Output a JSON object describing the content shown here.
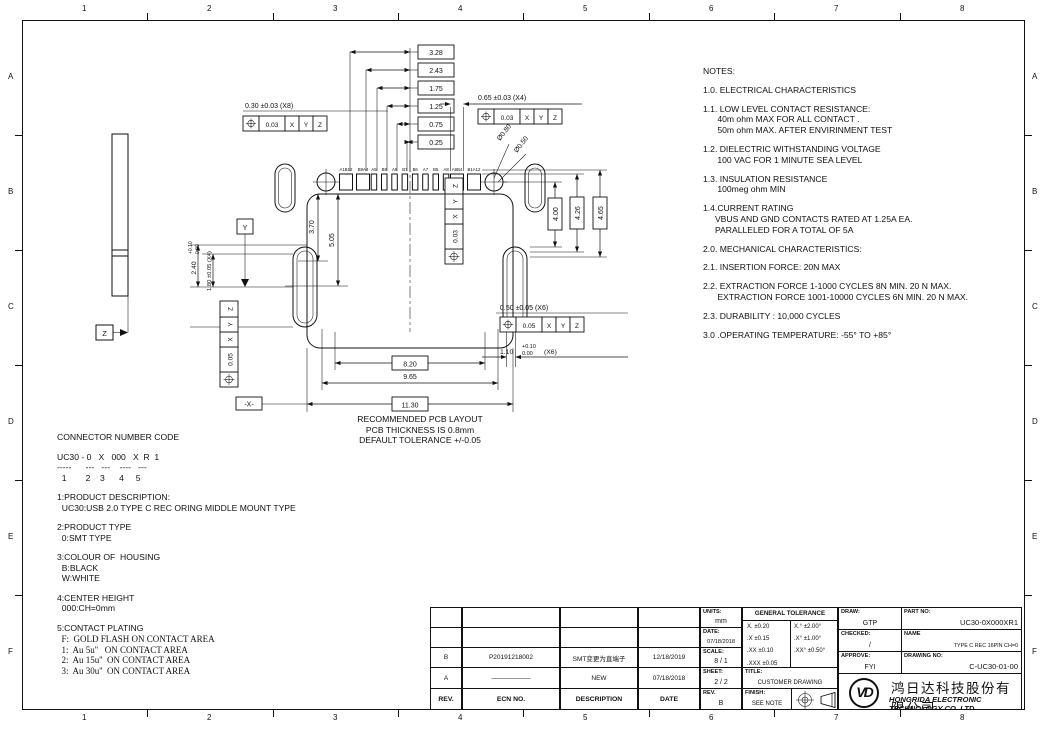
{
  "zones": {
    "cols": [
      "1",
      "2",
      "3",
      "4",
      "5",
      "6",
      "7",
      "8"
    ],
    "rows": [
      "A",
      "B",
      "C",
      "D",
      "E",
      "F"
    ]
  },
  "notes": {
    "heading": "NOTES:",
    "items": [
      "1.0. ELECTRICAL CHARACTERISTICS",
      "1.1. LOW LEVEL CONTACT RESISTANCE:\n      40m ohm MAX FOR ALL CONTACT .\n      50m ohm MAX. AFTER ENVIRINMENT TEST",
      "1.2. DIELECTRIC WITHSTANDING VOLTAGE\n      100 VAC FOR 1 MINUTE SEA LEVEL",
      "1.3. INSULATION RESISTANCE\n      100meg ohm MIN",
      "1.4.CURRENT RATING\n     VBUS AND GND CONTACTS RATED AT 1.25A EA.\n     PARALLELED FOR A TOTAL OF 5A",
      "2.0. MECHANICAL CHARACTERISTICS:",
      "2.1. INSERTION FORCE: 20N MAX",
      "2.2. EXTRACTION FORCE 1-1000 CYCLES 8N MIN. 20 N MAX.\n      EXTRACTION FORCE 1001-10000 CYCLES 6N MIN. 20 N MAX.",
      "2.3. DURABILITY : 10,000 CYCLES",
      "3.0 .OPERATING TEMPERATURE: -55° TO +85°"
    ]
  },
  "connector_code": {
    "heading": "CONNECTOR NUMBER CODE",
    "code_line": "UC30 - 0   X   000   X  R  1",
    "dash_line": "-----      ---   ---    ----   ---",
    "num_line": "  1        2    3      4     5",
    "sections": [
      "1:PRODUCT DESCRIPTION:\n  UC30:USB 2.0 TYPE C REC ORING MIDDLE MOUNT TYPE",
      "2:PRODUCT TYPE\n  0:SMT TYPE",
      "3:COLOUR OF  HOUSING\n  B:BLACK\n  W:WHITE",
      "4:CENTER HEIGHT\n  000:CH=0mm"
    ],
    "plating_heading": "5:CONTACT PLATING",
    "plating_lines": "  F:  GOLD FLASH ON CONTACT AREA\n  1:  Au 5u''   ON CONTACT AREA\n  2:  Au 15u''  ON CONTACT AREA\n  3:  Au 30u''  ON CONTACT AREA"
  },
  "pcb_note": "RECOMMENDED PCB LAYOUT\nPCB THICKNESS IS 0.8mm\nDEFAULT TOLERANCE +/-0.05",
  "drawing": {
    "stack_dims": [
      "3.28",
      "2.43",
      "1.75",
      "1.25",
      "0.75",
      "0.25"
    ],
    "pad_width_note": "0.30 ±0.03 (X8)",
    "wide_pad_note": "0.65 ±0.03 (X4)",
    "hole_dia_outer": "Ø0.80",
    "hole_dia_inner": "Ø0.50",
    "pin_labels": [
      "A1B12",
      "B9A4",
      "A5",
      "B8",
      "A6",
      "B7",
      "B6",
      "A7",
      "B5",
      "A8",
      "A9B4",
      "B1A12"
    ],
    "dim_3_70": "3.70",
    "dim_5_05": "5.05",
    "dim_4_00": "4.00",
    "dim_4_26": "4.26",
    "dim_4_65": "4.65",
    "dim_8_20": "8.20",
    "dim_9_65": "9.65",
    "dim_11_30": "11.30",
    "datum_x_label": "-X-",
    "datum_y_label": "Y",
    "datum_z_label": "Z",
    "slot_note": "0.50 ±0.05 (X6)",
    "slot_dim_main": "1.10",
    "slot_dim_plus": "+0.10",
    "slot_dim_minus": "0.00",
    "slot_dim_qty": "(X6)",
    "left_dim_main": "2.40",
    "left_dim_plus": "+0.10",
    "left_dim_minus": "0.00",
    "left_dim2": "1.80 ±0.05 (X4)",
    "fcf": {
      "symbol_name": "position-tolerance",
      "tol_003": "0.03",
      "tol_005": "0.05"
    },
    "datums": {
      "x": "X",
      "y": "Y",
      "z": "Z"
    }
  },
  "title_block": {
    "rev_table": {
      "headers": [
        "REV.",
        "ECN NO.",
        "DESCRIPTION",
        "DATE"
      ],
      "rows": [
        {
          "rev": "B",
          "ecn": "P20191218002",
          "desc": "SMT变更为直端子",
          "date": "12/18/2019"
        },
        {
          "rev": "A",
          "ecn": "——————",
          "desc": "NEW",
          "date": "07/18/2018"
        }
      ]
    },
    "units_label": "UNITS:",
    "units_value": "mm",
    "date_label": "DATE:",
    "date_value": "07/18/2018",
    "scale_label": "SCALE:",
    "scale_value": "8 / 1",
    "sheet_label": "SHEET:",
    "sheet_value": "2 / 2",
    "rev_label": "REV.",
    "rev_value": "B",
    "tolerance": {
      "heading": "GENERAL TOLERANCE",
      "rows": [
        [
          "X.   ±0.20",
          "X.°   ±2.00°"
        ],
        [
          ".X   ±0.15",
          ".X°   ±1.00°"
        ],
        [
          ".XX  ±0.10",
          ".XX°  ±0.50°"
        ],
        [
          ".XXX ±0.05",
          ""
        ]
      ]
    },
    "title_label": "TITLE:",
    "title_value": "CUSTOMER DRAWING",
    "finish_label": "FINISH:",
    "finish_value": "SEE NOTE",
    "draw_label": "DRAW:",
    "draw_value": "GTP",
    "checked_label": "CHECKED:",
    "checked_value": "/",
    "approve_label": "APPROVE:",
    "approve_value": "FYI",
    "part_label": "PART NO:",
    "part_value": "UC30-0X000XR1",
    "name_label": "NAME",
    "name_value": "TYPE C REC 16PIN CH=0",
    "drawing_no_label": "DRAWING NO:",
    "drawing_no_value": "C-UC30-01-00",
    "logo_text": "VD",
    "company_cn": "鸿日达科技股份有限公司",
    "company_en": "HONGRIDA ELECTRONIC TECHNOLOGY CO.,LTD."
  }
}
